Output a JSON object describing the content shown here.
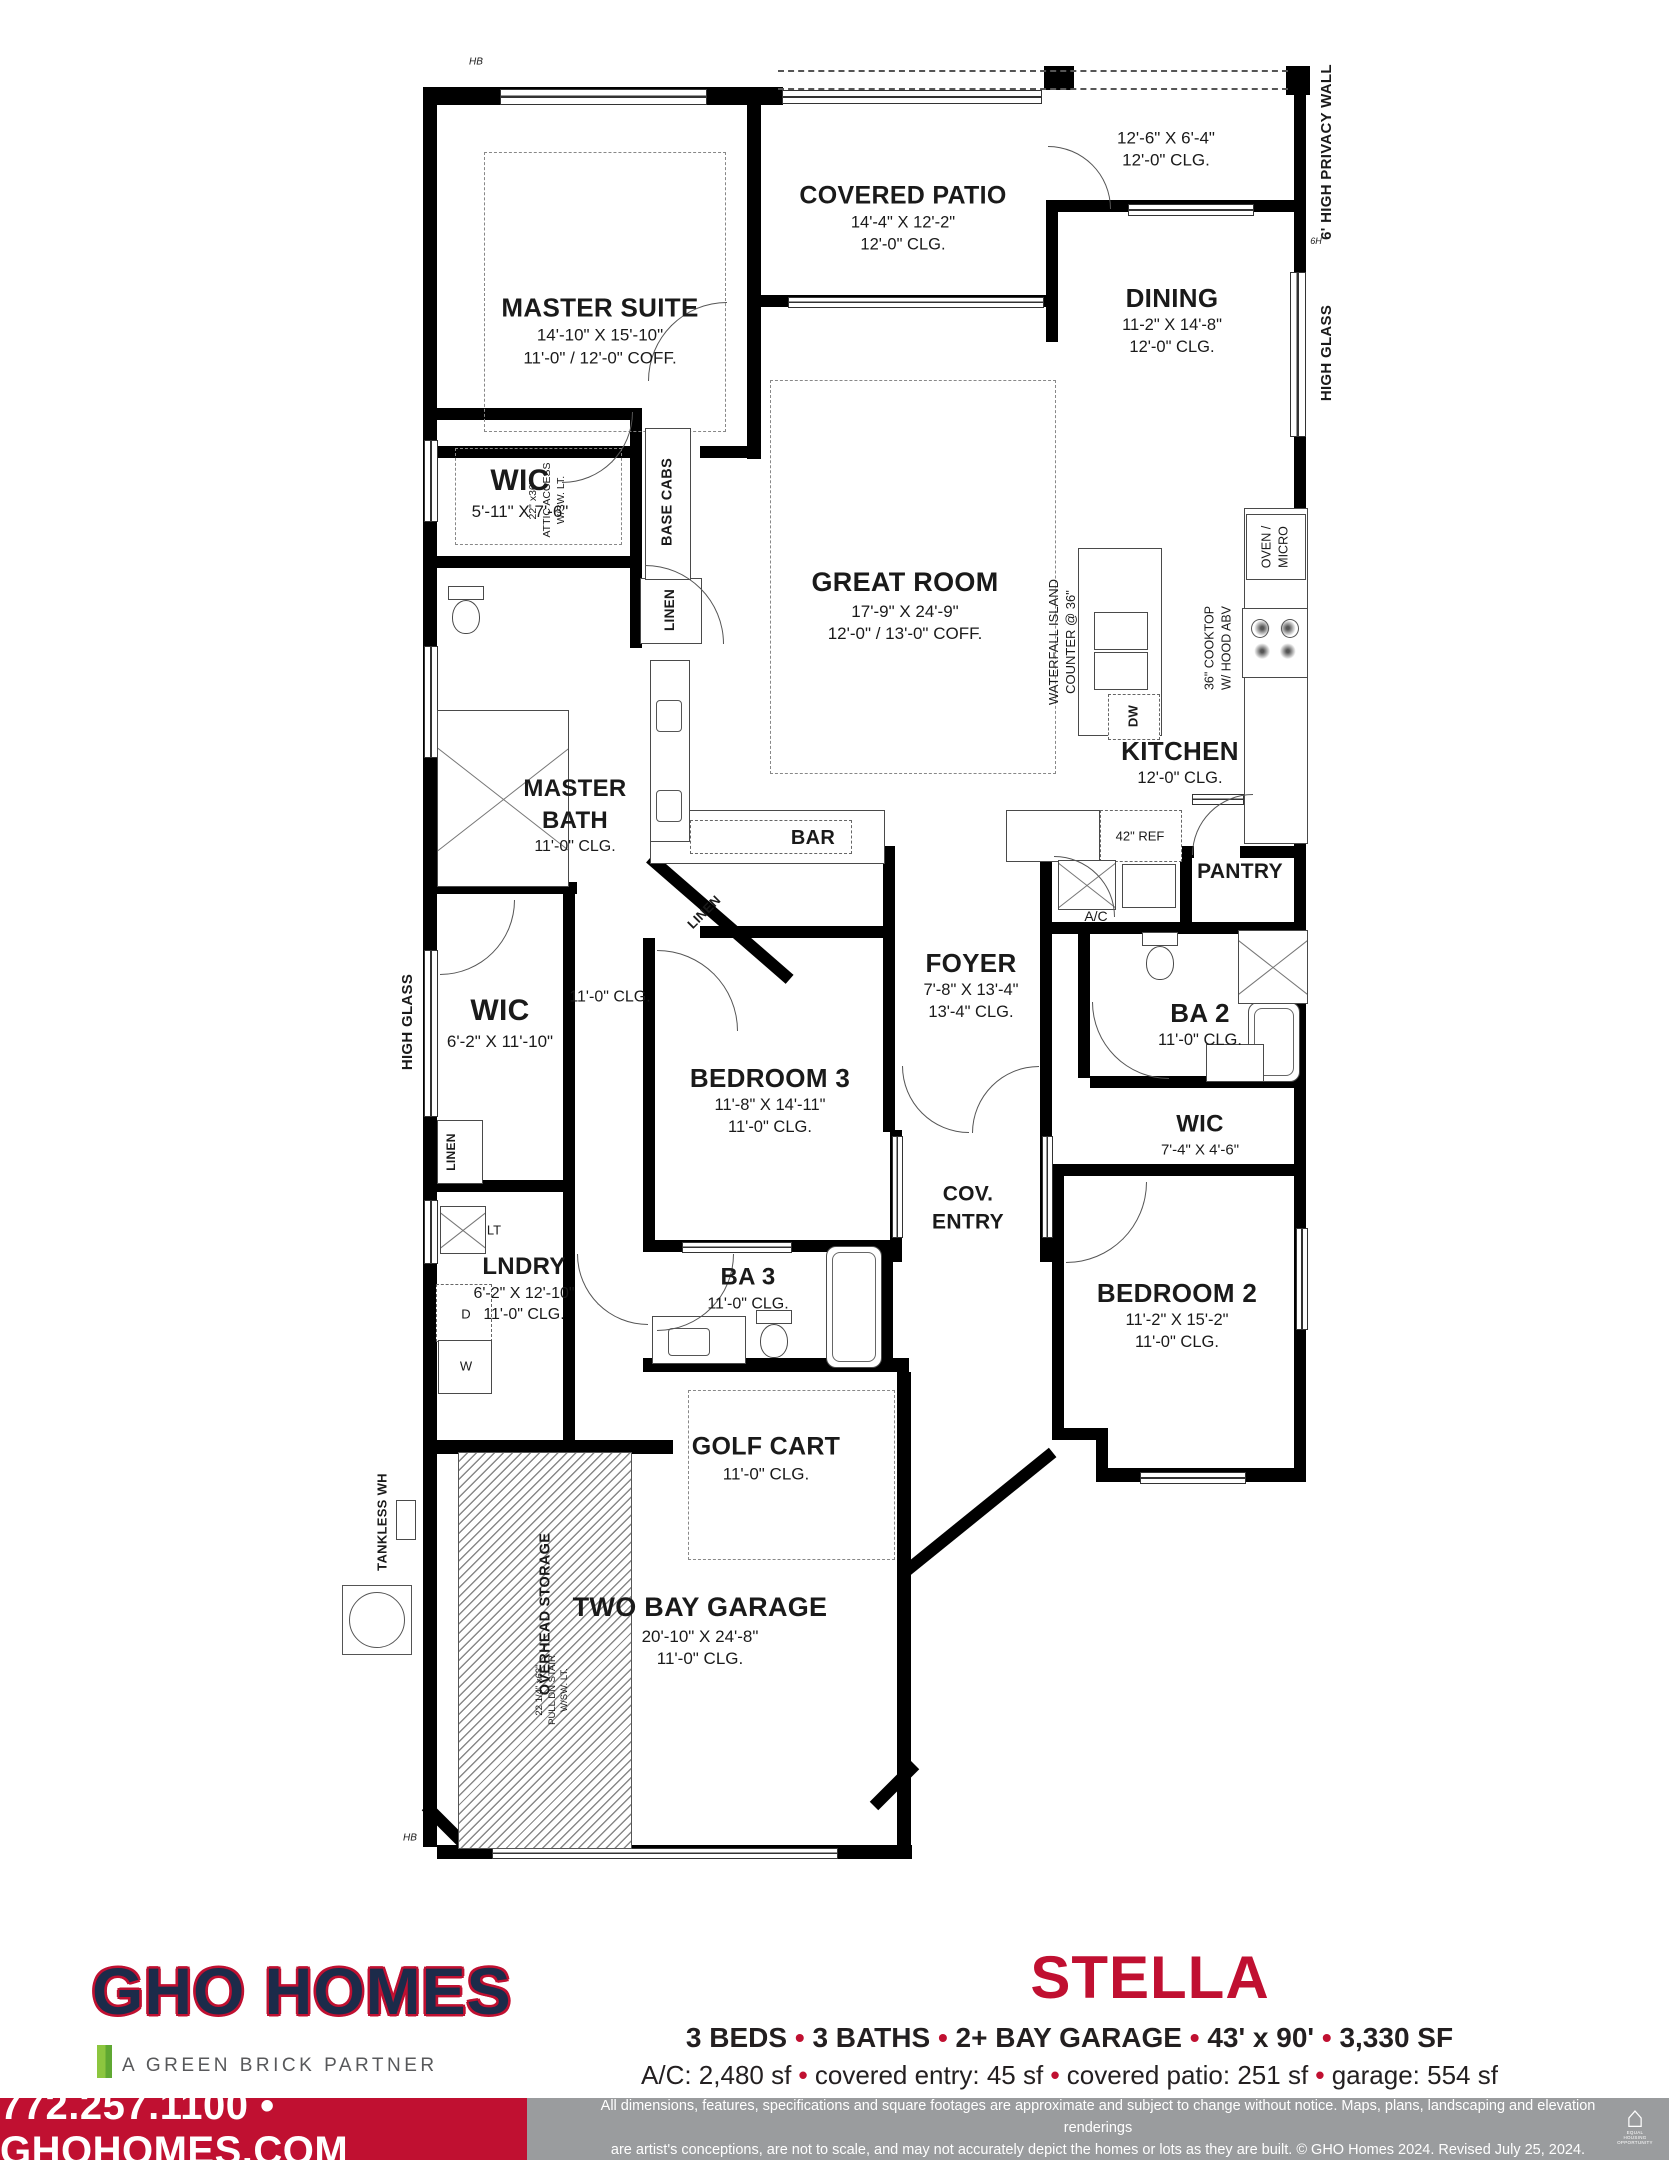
{
  "plan": {
    "labels": [
      {
        "id": "hb-top",
        "lines": [
          "HB"
        ]
      },
      {
        "id": "master-suite",
        "lines": [
          "MASTER SUITE",
          "14'-10\" X 15'-10\"",
          "11'-0\" / 12'-0\" COFF."
        ]
      },
      {
        "id": "covered-patio",
        "lines": [
          "COVERED PATIO",
          "14'-4\" X 12'-2\"",
          "12'-0\" CLG."
        ]
      },
      {
        "id": "patio-ext",
        "lines": [
          "12'-6\" X 6'-4\"",
          "12'-0\" CLG."
        ]
      },
      {
        "id": "dining",
        "lines": [
          "DINING",
          "11-2\" X 14'-8\"",
          "12'-0\" CLG."
        ]
      },
      {
        "id": "privacy-wall",
        "lines": [
          "6' HIGH PRIVACY WALL"
        ]
      },
      {
        "id": "high-glass-right",
        "lines": [
          "HIGH GLASS"
        ]
      },
      {
        "id": "six-h",
        "lines": [
          "6H"
        ]
      },
      {
        "id": "wic1",
        "lines": [
          "WIC",
          "5'-11\" X 7'-6\""
        ]
      },
      {
        "id": "attic",
        "lines": [
          "22\" x36\"",
          "ATTIC ACCESS",
          "W/SW. LT."
        ]
      },
      {
        "id": "base-cabs",
        "lines": [
          "BASE CABS"
        ]
      },
      {
        "id": "great-room",
        "lines": [
          "GREAT ROOM",
          "17'-9\" X 24'-9\"",
          "12'-0\" / 13'-0\" COFF."
        ]
      },
      {
        "id": "linen1",
        "lines": [
          "LINEN"
        ]
      },
      {
        "id": "island",
        "lines": [
          "WATERFALL ISLAND",
          "COUNTER @ 36\""
        ]
      },
      {
        "id": "dw",
        "lines": [
          "DW"
        ]
      },
      {
        "id": "oven-micro",
        "lines": [
          "OVEN /",
          "MICRO"
        ]
      },
      {
        "id": "cooktop",
        "lines": [
          "36\" COOKTOP",
          "W/ HOOD ABV"
        ]
      },
      {
        "id": "master-bath",
        "lines": [
          "MASTER",
          "BATH",
          "11'-0\" CLG."
        ]
      },
      {
        "id": "kitchen",
        "lines": [
          "KITCHEN",
          "12'-0\" CLG."
        ]
      },
      {
        "id": "bar",
        "lines": [
          "BAR"
        ]
      },
      {
        "id": "ref",
        "lines": [
          "42\" REF"
        ]
      },
      {
        "id": "pantry",
        "lines": [
          "PANTRY"
        ]
      },
      {
        "id": "ac",
        "lines": [
          "A/C"
        ]
      },
      {
        "id": "linen2",
        "lines": [
          "LINEN"
        ]
      },
      {
        "id": "high-glass-left",
        "lines": [
          "HIGH GLASS"
        ]
      },
      {
        "id": "wic2",
        "lines": [
          "WIC",
          "6'-2\" X 11'-10\""
        ]
      },
      {
        "id": "hall-clg",
        "lines": [
          "11'-0\" CLG."
        ]
      },
      {
        "id": "foyer",
        "lines": [
          "FOYER",
          "7'-8\" X 13'-4\"",
          "13'-4\" CLG."
        ]
      },
      {
        "id": "ba2",
        "lines": [
          "BA 2",
          "11'-0\" CLG."
        ]
      },
      {
        "id": "bedroom3",
        "lines": [
          "BEDROOM 3",
          "11'-8\" X 14'-11\"",
          "11'-0\" CLG."
        ]
      },
      {
        "id": "wic3",
        "lines": [
          "WIC",
          "7'-4\" X 4'-6\""
        ]
      },
      {
        "id": "cov-entry",
        "lines": [
          "COV.",
          "ENTRY"
        ]
      },
      {
        "id": "linen3",
        "lines": [
          "LINEN"
        ]
      },
      {
        "id": "lt",
        "lines": [
          "LT"
        ]
      },
      {
        "id": "lndry",
        "lines": [
          "LNDRY",
          "6'-2\" X 12'-10\"",
          "11'-0\" CLG."
        ]
      },
      {
        "id": "d",
        "lines": [
          "D"
        ]
      },
      {
        "id": "w",
        "lines": [
          "W"
        ]
      },
      {
        "id": "ba3",
        "lines": [
          "BA 3",
          "11'-0\" CLG."
        ]
      },
      {
        "id": "bedroom2",
        "lines": [
          "BEDROOM 2",
          "11'-2\" X 15'-2\"",
          "11'-0\" CLG."
        ]
      },
      {
        "id": "golf-cart",
        "lines": [
          "GOLF CART",
          "11'-0\" CLG."
        ]
      },
      {
        "id": "tankless",
        "lines": [
          "TANKLESS WH"
        ]
      },
      {
        "id": "overhead",
        "lines": [
          "OVERHEAD STORAGE"
        ]
      },
      {
        "id": "stair",
        "lines": [
          "22 1/4\" x63\"",
          "PULL DN STAIR",
          "W/SW. LT."
        ]
      },
      {
        "id": "garage",
        "lines": [
          "TWO BAY GARAGE",
          "20'-10\" X 24'-8\"",
          "11'-0\" CLG."
        ]
      },
      {
        "id": "hb-bottom",
        "lines": [
          "HB"
        ]
      }
    ]
  },
  "footer": {
    "brand": "GHO HOMES",
    "brand_sub": "A GREEN BRICK PARTNER",
    "plan_name": "STELLA",
    "specs_line1": "3 BEDS • 3 BATHS • 2+ BAY GARAGE • 43' x 90' • 3,330 SF",
    "specs_line2": "A/C: 2,480 sf • covered entry: 45 sf • covered patio: 251 sf • garage: 554 sf",
    "contact": "772.257.1100 • GHOHOMES.COM",
    "disclaimer_line1": "All dimensions, features, specifications and square footages are approximate and subject to change without notice. Maps, plans, landscaping and elevation renderings",
    "disclaimer_line2": "are artist's conceptions, are not to scale, and may not accurately depict the homes or lots as they are built. © GHO Homes 2024. Revised July 25, 2024.",
    "equal_housing": "EQUAL HOUSING OPPORTUNITY",
    "colors": {
      "accent": "#C01031",
      "navy": "#1C2B4A",
      "green": "#8CC63F",
      "gray_bar": "#9A9C9E"
    }
  }
}
